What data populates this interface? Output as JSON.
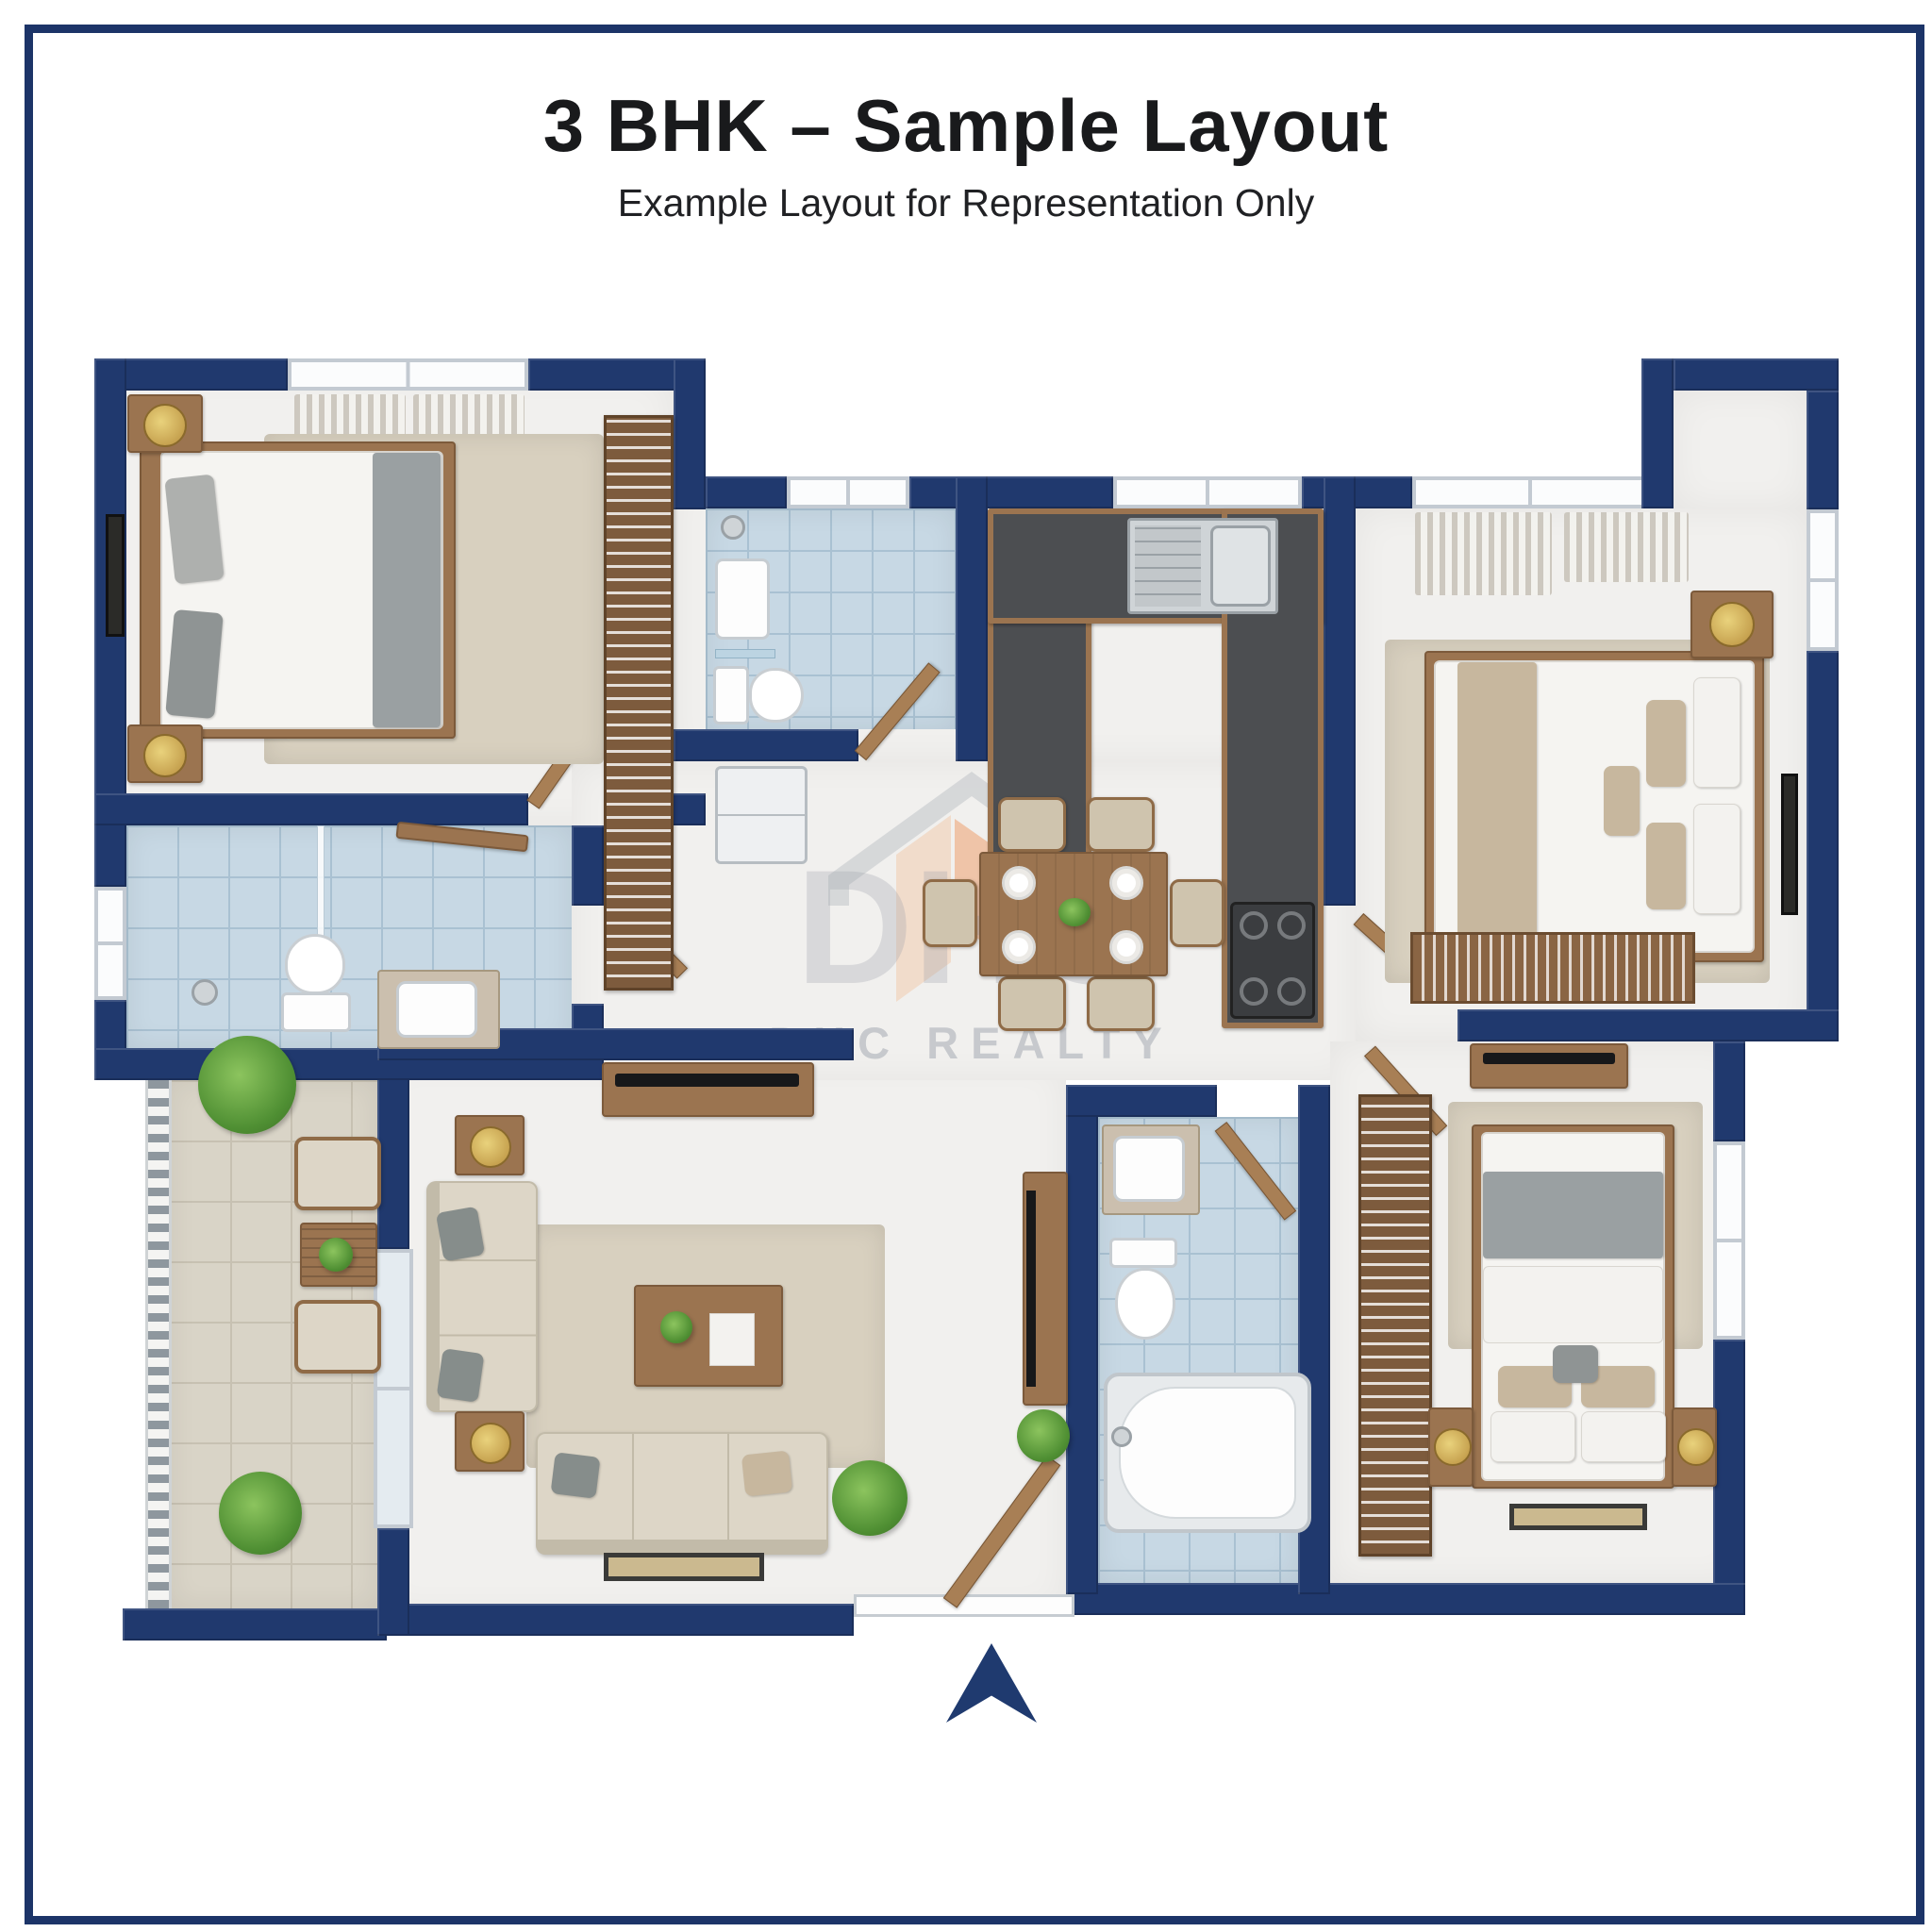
{
  "header": {
    "title": "3 BHK – Sample Layout",
    "subtitle": "Example Layout for Representation Only"
  },
  "watermark": {
    "logo_text": "DHC",
    "caption": "DHC REALTY"
  },
  "colors": {
    "wall_navy": "#20396e",
    "frame_navy": "#1c3468",
    "floor_white": "#f1f0ee",
    "bathroom_tile": "#c7d8e4",
    "balcony_tile": "#d9d4c7",
    "rug_beige": "#d8d0bf",
    "wood": "#9b7450",
    "counter_dark": "#4c4e51",
    "fabric": "#ddd6c7",
    "plant_green": "#4f8f33",
    "watermark_gray": "#a4a9b2",
    "watermark_orange": "#ef7f3a"
  },
  "floorplan": {
    "type": "3 BHK apartment top-view render",
    "entrance_marker": "navy arrow at bottom center pointing to main door",
    "rooms": [
      {
        "name": "bedroom-1",
        "position": "top-left",
        "fixtures": [
          "double-bed",
          "two-nightstands-with-lamps",
          "wall-art",
          "wardrobe-with-hangers",
          "window-curtains",
          "beige-rug"
        ]
      },
      {
        "name": "common-bathroom",
        "position": "middle-left",
        "fixtures": [
          "shower-glass-partition",
          "toilet",
          "vanity-sink",
          "wood-shelf",
          "window"
        ]
      },
      {
        "name": "balcony",
        "position": "bottom-left",
        "fixtures": [
          "railing",
          "two-armchairs",
          "slat-table",
          "potted-plants"
        ]
      },
      {
        "name": "living-room",
        "position": "bottom-center",
        "fixtures": [
          "l-shaped-sofa-set",
          "coffee-table",
          "side-tables-with-lamps",
          "rug",
          "doormat",
          "tv-console",
          "plant",
          "main-entrance-door"
        ]
      },
      {
        "name": "dining-area",
        "position": "center",
        "fixtures": [
          "six-seater-dining-table",
          "four-place-settings",
          "centerpiece"
        ]
      },
      {
        "name": "kitchen",
        "position": "top-center",
        "fixtures": [
          "u-shaped-counter",
          "double-sink-with-drainboard",
          "four-burner-hob",
          "window"
        ]
      },
      {
        "name": "attached-bathroom-1",
        "position": "top-center-left",
        "fixtures": [
          "shower",
          "wash-basin",
          "toilet"
        ],
        "adjacent": "refrigerator-niche"
      },
      {
        "name": "bedroom-2-master",
        "position": "top-right",
        "fixtures": [
          "double-bed",
          "nightstand-with-lamp",
          "bookshelf",
          "wall-art",
          "window-curtains",
          "beige-rug"
        ]
      },
      {
        "name": "attached-bathroom-2",
        "position": "bottom-middle",
        "fixtures": [
          "bathtub",
          "toilet",
          "vanity-sink"
        ]
      },
      {
        "name": "bedroom-3",
        "position": "bottom-right",
        "fixtures": [
          "double-bed",
          "two-nightstands-with-lamps",
          "wardrobe-with-hangers",
          "tv-dresser",
          "window",
          "doormat",
          "beige-rug"
        ]
      }
    ]
  }
}
